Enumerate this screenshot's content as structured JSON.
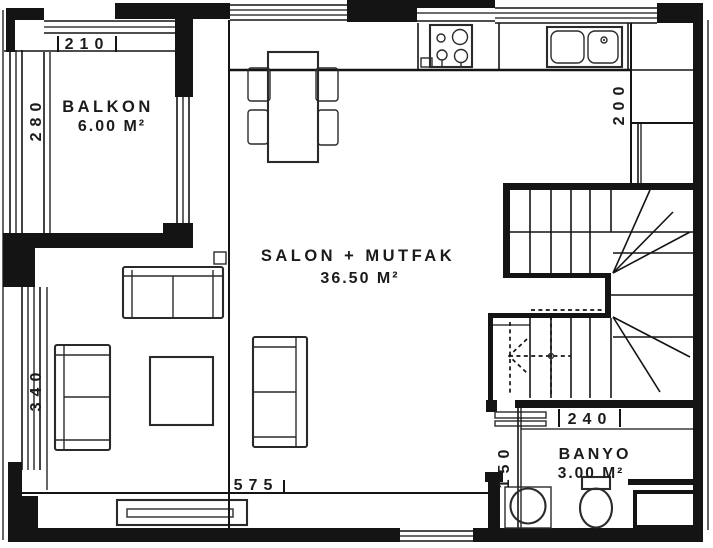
{
  "plan_type": "apartment-floor-plan",
  "rooms": [
    {
      "name": "BALKON",
      "area": "6.00 M²"
    },
    {
      "name": "SALON + MUTFAK",
      "area": "36.50 M²"
    },
    {
      "name": "BANYO",
      "area": "3.00 M²"
    }
  ],
  "dimensions": {
    "balcony_width": "210",
    "balcony_depth": "280",
    "living_wall_left": "340",
    "living_width": "575",
    "kitchen_counter_depth": "200",
    "bath_width": "240",
    "bath_strip": "150"
  },
  "symbols": [
    "dining-table",
    "dining-chair",
    "kitchen-stove",
    "kitchen-sink",
    "sofa",
    "loveseat",
    "armchair",
    "coffee-table",
    "tv-unit",
    "staircase",
    "stair-direction-arrow",
    "bath-door",
    "bathroom-sink",
    "toilet",
    "shower-tray",
    "window"
  ],
  "colors": {
    "line": "#141414",
    "background": "#ffffff"
  }
}
